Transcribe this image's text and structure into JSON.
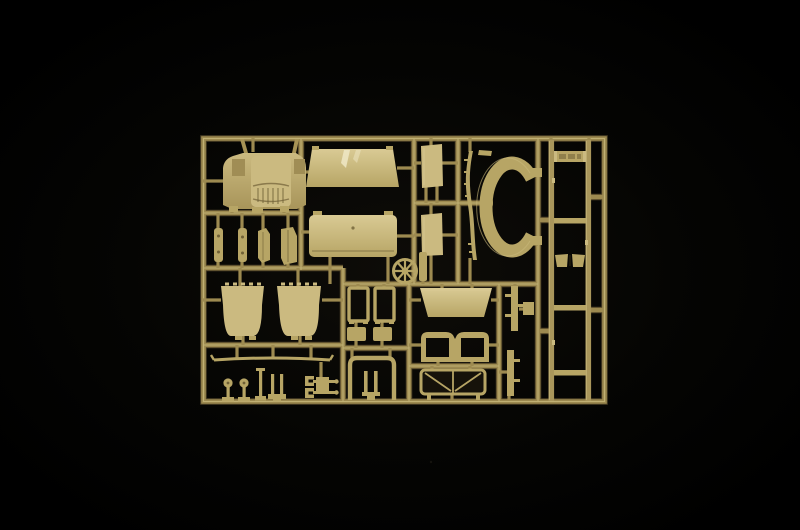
{
  "scene": {
    "description": "Photograph of a tan injection-moulded plastic model kit sprue (parts tree) containing truck model parts, lit against a black background",
    "object_type": "plastic model sprue / parts tree",
    "text_visible": "none"
  },
  "colors": {
    "background": "#000000",
    "vignette": "#0e0c08",
    "runner": "#9d8a50",
    "runner-shadow": "#4d4126",
    "runner-light": "#c9b97c",
    "plastic": "#b7a565",
    "plastic-light": "#cbba80",
    "plastic-lighter": "#d9ca94",
    "plastic-dark": "#6f6036",
    "highlight": "#efe7c6"
  },
  "sprue": {
    "frame": {
      "left": 201,
      "top": 136,
      "right": 607,
      "bottom": 404
    },
    "parts": [
      {
        "id": "hood",
        "name": "truck-hood-front-panel",
        "x": 222,
        "y": 139,
        "w": 84,
        "h": 74
      },
      {
        "id": "roof",
        "name": "cab-roof-panel",
        "x": 306,
        "y": 146,
        "w": 94,
        "h": 42
      },
      {
        "id": "rear",
        "name": "cab-rear-panel",
        "x": 309,
        "y": 211,
        "w": 88,
        "h": 46
      },
      {
        "id": "door_u",
        "name": "door-panel-upper",
        "x": 420,
        "y": 144,
        "w": 23,
        "h": 44
      },
      {
        "id": "door_l",
        "name": "door-panel-lower",
        "x": 420,
        "y": 213,
        "w": 23,
        "h": 44
      },
      {
        "id": "blade",
        "name": "fender-blade",
        "x": 463,
        "y": 150,
        "w": 14,
        "h": 112
      },
      {
        "id": "cring",
        "name": "wheel-arch-c-ring",
        "x": 482,
        "y": 160,
        "w": 60,
        "h": 94
      },
      {
        "id": "wheel",
        "name": "steering-wheel",
        "x": 392,
        "y": 258,
        "w": 27,
        "h": 27
      },
      {
        "id": "seat_l",
        "name": "seat-back-left",
        "x": 219,
        "y": 283,
        "w": 47,
        "h": 56
      },
      {
        "id": "seat_r",
        "name": "seat-back-right",
        "x": 275,
        "y": 283,
        "w": 48,
        "h": 56
      },
      {
        "id": "strip_a",
        "name": "bracket-strip-a",
        "x": 214,
        "y": 228,
        "w": 9,
        "h": 34
      },
      {
        "id": "strip_b",
        "name": "bracket-strip-b",
        "x": 238,
        "y": 228,
        "w": 9,
        "h": 34
      },
      {
        "id": "hinge_a",
        "name": "hinge-bracket-a",
        "x": 257,
        "y": 228,
        "w": 14,
        "h": 35
      },
      {
        "id": "hinge_b",
        "name": "hinge-bracket-b",
        "x": 280,
        "y": 227,
        "w": 17,
        "h": 38
      },
      {
        "id": "spring",
        "name": "leaf-spring",
        "x": 212,
        "y": 355,
        "w": 120,
        "h": 8
      },
      {
        "id": "knob_a",
        "name": "mirror-stalk-a",
        "x": 222,
        "y": 378,
        "w": 12,
        "h": 24
      },
      {
        "id": "knob_b",
        "name": "mirror-stalk-b",
        "x": 238,
        "y": 378,
        "w": 12,
        "h": 24
      },
      {
        "id": "pin",
        "name": "lever-pin",
        "x": 255,
        "y": 368,
        "w": 11,
        "h": 33
      },
      {
        "id": "fork",
        "name": "fork-bracket",
        "x": 268,
        "y": 374,
        "w": 18,
        "h": 26
      },
      {
        "id": "cluster",
        "name": "axle-bracket-cluster",
        "x": 302,
        "y": 373,
        "w": 36,
        "h": 26
      },
      {
        "id": "gate_l",
        "name": "frame-gate-left",
        "x": 348,
        "y": 284,
        "w": 21,
        "h": 40
      },
      {
        "id": "gate_r",
        "name": "frame-gate-right",
        "x": 374,
        "y": 284,
        "w": 21,
        "h": 40
      },
      {
        "id": "plate_l",
        "name": "base-plate-left",
        "x": 347,
        "y": 327,
        "w": 19,
        "h": 14
      },
      {
        "id": "plate_r",
        "name": "base-plate-right",
        "x": 373,
        "y": 327,
        "w": 19,
        "h": 14
      },
      {
        "id": "rollbar",
        "name": "roll-bar-frame",
        "x": 347,
        "y": 355,
        "w": 50,
        "h": 46
      },
      {
        "id": "cargo",
        "name": "cargo-bed-panel",
        "x": 420,
        "y": 287,
        "w": 72,
        "h": 31
      },
      {
        "id": "windshield",
        "name": "windshield-frame",
        "x": 420,
        "y": 331,
        "w": 70,
        "h": 32
      },
      {
        "id": "bench",
        "name": "bench-seat-frame",
        "x": 420,
        "y": 368,
        "w": 66,
        "h": 33
      },
      {
        "id": "rstrip_u",
        "name": "bracket-strip-upper-right",
        "x": 505,
        "y": 285,
        "w": 28,
        "h": 47
      },
      {
        "id": "rstrip_l",
        "name": "bracket-strip-lower-right",
        "x": 506,
        "y": 349,
        "w": 14,
        "h": 48
      },
      {
        "id": "ladder",
        "name": "chassis-ladder-frame",
        "x": 548,
        "y": 139,
        "w": 44,
        "h": 263,
        "crossmembers": 5
      }
    ]
  }
}
